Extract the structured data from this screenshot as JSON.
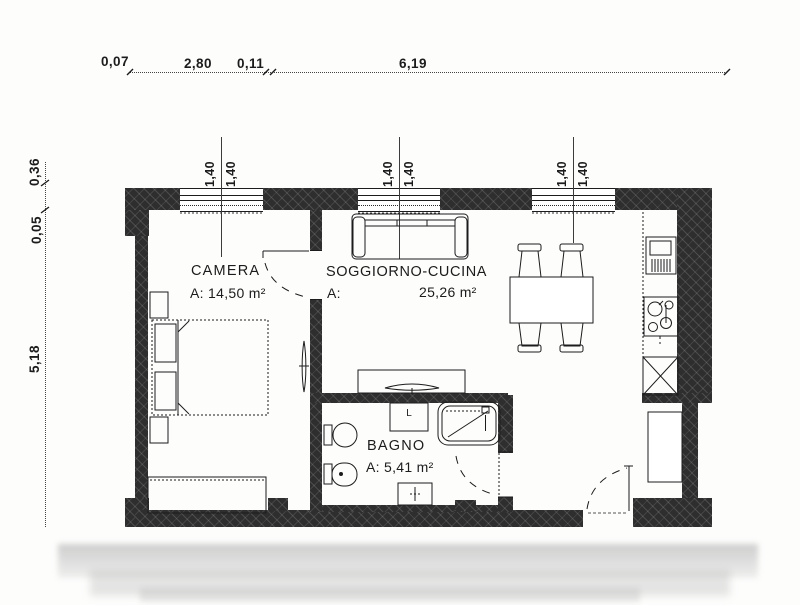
{
  "drawing": {
    "kind": "apartment floor plan",
    "rooms": {
      "camera": {
        "name": "CAMERA",
        "area": "A: 14,50 m²"
      },
      "soggiorno_cucina": {
        "name": "SOGGIORNO-CUCINA",
        "area_prefix": "A:",
        "area_value": "25,26 m²"
      },
      "bagno": {
        "name": "BAGNO",
        "area": "A: 5,41 m²"
      },
      "washer_label": "L"
    },
    "dims_top": [
      "0,07",
      "2,80",
      "0,11",
      "6,19"
    ],
    "dims_left": [
      "0,36",
      "0,05",
      "5,18"
    ],
    "window_dims": [
      "1,40",
      "1,40",
      "1,40",
      "1,40",
      "1,40",
      "1,40"
    ],
    "colors": {
      "wall": "#2e2e2e",
      "line": "#1c1c1c",
      "background": "#fdfdfc"
    }
  }
}
